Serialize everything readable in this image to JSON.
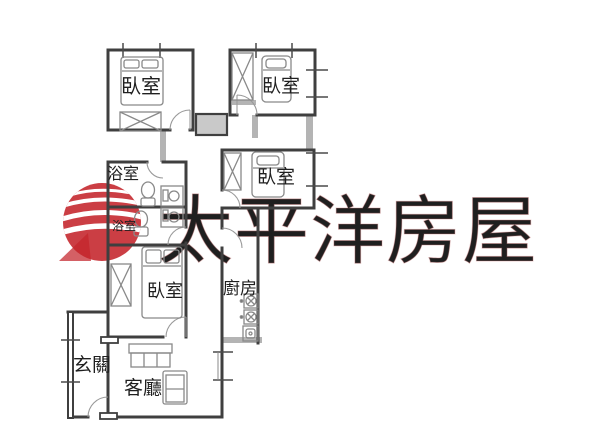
{
  "watermark": {
    "brand_text": "太平洋房屋",
    "brand_text_color": "#9e9e9e",
    "logo_color": "#c4232a"
  },
  "labels": {
    "bedroom_top_left": "臥室",
    "bedroom_top_right": "臥室",
    "bedroom_middle_right": "臥室",
    "bedroom_lower": "臥室",
    "bathroom_upper": "浴室",
    "bathroom_lower": "浴室",
    "kitchen": "廚房",
    "entryway": "玄關",
    "living_room": "客廳"
  }
}
